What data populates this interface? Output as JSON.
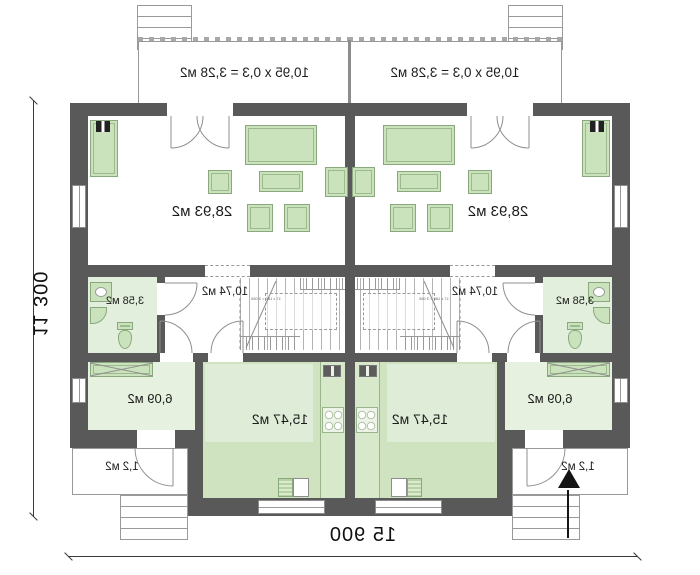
{
  "dims": {
    "width": "15 900",
    "height": "11 300"
  },
  "unit": {
    "terrace": "10,95 x 0,3 = 3,28 м2",
    "living": "28,93 м2",
    "hall": "10,74 м2",
    "bathroom": "3,58 м2",
    "room": "6,09 м2",
    "kitchen": "15,47 м2",
    "porch": "1,2 м2",
    "stairs_note": "17 x 180 = 3 060"
  },
  "colors": {
    "wall": "#595959",
    "furniture_fill": "#cbe3bc",
    "furniture_stroke": "#8aa87d",
    "kitchen_floor": "#cfe3c1",
    "room_floor": "#e6f1e0",
    "bath_floor": "#e3efdd",
    "line": "#8c8c8c"
  }
}
